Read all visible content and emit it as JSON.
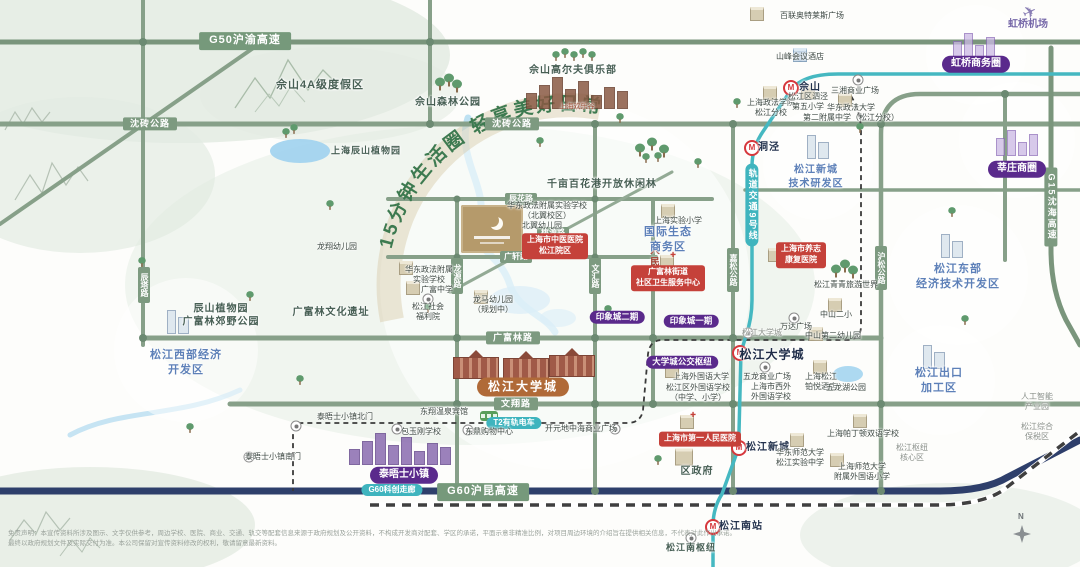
{
  "slogan": "15分钟生活圈 轻享美好日常",
  "disclaimer": {
    "line1": "免责声明：本宣传资料所涉及图示、文字仅供参考，周边学校、医院、商业、交通、轨交等配套信息来源于政府规划及公开资料，不构成开发商对配套、学区的承诺，平面示意非精准比例，对项目周边环境的介绍旨在提供相关信息，不代表对此作出承诺。",
    "line2": "最终以政府规划文件及实际交付为准。本公司保留对宣传资料修改的权利，敬请留意最新资料。"
  },
  "compass": {
    "north_label": "N"
  },
  "project": {
    "logo_icon": "crescent-moon-logo"
  },
  "colors": {
    "road_green": "#7d9a80",
    "highway_navy": "#2e3f6b",
    "metro_teal": "#3fb4be",
    "purple_pill": "#5a2a8c",
    "red_tag": "#c5413a",
    "area_blue": "#5d80b8",
    "slogan_green": "#3d7a50",
    "orange_pill": "#b06a38"
  },
  "labels": [
    {
      "n": "road-label-g50",
      "t": "G50沪渝高速",
      "x": 245,
      "y": 41,
      "c": "pill-road big"
    },
    {
      "n": "road-label-shenzhuan-west",
      "t": "沈砖公路",
      "x": 150,
      "y": 124,
      "c": "pill-road"
    },
    {
      "n": "road-label-shenzhuan",
      "t": "沈砖公路",
      "x": 512,
      "y": 124,
      "c": "pill-road"
    },
    {
      "n": "road-label-chenhua",
      "t": "辰花路",
      "x": 521,
      "y": 199,
      "c": "pill-road sm"
    },
    {
      "n": "road-label-taoyuan",
      "t": "桃源路",
      "x": 553,
      "y": 233,
      "c": "pill-road sm"
    },
    {
      "n": "road-label-guangxuan",
      "t": "广轩路",
      "x": 516,
      "y": 257,
      "c": "pill-road sm"
    },
    {
      "n": "road-label-guangfulin",
      "t": "广富林路",
      "x": 513,
      "y": 338,
      "c": "pill-road"
    },
    {
      "n": "road-label-wenxiang",
      "t": "文翔路",
      "x": 516,
      "y": 404,
      "c": "pill-road"
    },
    {
      "n": "road-label-g60",
      "t": "G60沪昆高速",
      "x": 483,
      "y": 492,
      "c": "pill-road big"
    },
    {
      "n": "road-label-g15",
      "t": "G15沈海高速",
      "x": 1051,
      "y": 207,
      "c": "pill-road vert"
    },
    {
      "n": "road-label-chenta",
      "t": "辰塔路",
      "x": 144,
      "y": 285,
      "c": "pill-road vert sm"
    },
    {
      "n": "road-label-longyuan",
      "t": "龙源路",
      "x": 457,
      "y": 276,
      "c": "pill-road vert sm"
    },
    {
      "n": "road-label-wenhui",
      "t": "文汇路",
      "x": 595,
      "y": 276,
      "c": "pill-road vert sm"
    },
    {
      "n": "road-label-renminbei",
      "t": "人民北路",
      "x": 653,
      "y": 268,
      "c": "road-red vert"
    },
    {
      "n": "road-label-jiasong",
      "t": "嘉松公路",
      "x": 733,
      "y": 270,
      "c": "pill-road vert sm"
    },
    {
      "n": "road-label-husong",
      "t": "沪松公路",
      "x": 881,
      "y": 268,
      "c": "pill-road vert sm"
    },
    {
      "n": "label-g60-corridor",
      "t": "G60科创走廊",
      "x": 392,
      "y": 490,
      "c": "teal-tag"
    },
    {
      "n": "label-t2-tram",
      "t": "T2有轨电车",
      "x": 514,
      "y": 423,
      "c": "teal-tag"
    },
    {
      "n": "label-metro-line9",
      "t": "轨道交通9号线",
      "x": 752,
      "y": 205,
      "c": "metro-vert vert"
    },
    {
      "n": "pill-hongqiao-cbd",
      "t": "虹桥商务圈",
      "x": 976,
      "y": 64,
      "c": "pill-purple"
    },
    {
      "n": "pill-xinzhuang-cbd",
      "t": "莘庄商圈",
      "x": 1017,
      "y": 169,
      "c": "pill-purple"
    },
    {
      "n": "pill-yinxiangcheng-2",
      "t": "印象城二期",
      "x": 617,
      "y": 317,
      "c": "pill-purple sm"
    },
    {
      "n": "pill-yinxiangcheng-1",
      "t": "印象城一期",
      "x": 691,
      "y": 321,
      "c": "pill-purple sm"
    },
    {
      "n": "pill-bus-hub",
      "t": "大学城公交枢纽",
      "x": 682,
      "y": 362,
      "c": "pill-purple sm"
    },
    {
      "n": "pill-thames-town",
      "t": "泰晤士小镇",
      "x": 404,
      "y": 475,
      "c": "pill-purple"
    },
    {
      "n": "pill-univ-town",
      "t": "松江大学城",
      "x": 523,
      "y": 387,
      "c": "pill-orange"
    },
    {
      "n": "area-songjiang-newcity-rd",
      "t": "松江新城\n技术研发区",
      "x": 816,
      "y": 177,
      "c": "area-blue s10"
    },
    {
      "n": "area-eco-business",
      "t": "国际生态\n商务区",
      "x": 668,
      "y": 240,
      "c": "area-blue"
    },
    {
      "n": "area-east-dev",
      "t": "松江东部\n经济技术开发区",
      "x": 958,
      "y": 277,
      "c": "area-blue"
    },
    {
      "n": "area-export-zone",
      "t": "松江出口\n加工区",
      "x": 939,
      "y": 381,
      "c": "area-blue"
    },
    {
      "n": "area-west-dev",
      "t": "松江西部经济\n开发区",
      "x": 186,
      "y": 363,
      "c": "area-blue"
    },
    {
      "n": "label-sheshan-resort",
      "t": "佘山4A级度假区",
      "x": 320,
      "y": 86,
      "c": "area-dark"
    },
    {
      "n": "label-sheshan-forest-park",
      "t": "佘山森林公园",
      "x": 448,
      "y": 103,
      "c": "area-dark s10"
    },
    {
      "n": "label-sheshan-golf",
      "t": "佘山高尔夫俱乐部",
      "x": 573,
      "y": 71,
      "c": "area-dark s10"
    },
    {
      "n": "label-happy-valley",
      "t": "上海欢乐谷",
      "x": 577,
      "y": 108,
      "c": "brown",
      "fs": 7
    },
    {
      "n": "label-chenshan-garden",
      "t": "上海辰山植物园",
      "x": 366,
      "y": 151,
      "c": "area-dark s9"
    },
    {
      "n": "label-flower-park",
      "t": "千亩百花港开放休闲林",
      "x": 602,
      "y": 185,
      "c": "area-dark s10"
    },
    {
      "n": "label-country-park",
      "t": "辰山植物园\n广富林郊野公园",
      "x": 221,
      "y": 316,
      "c": "area-dark s10"
    },
    {
      "n": "label-guangfulin-relic",
      "t": "广富林文化遗址",
      "x": 331,
      "y": 313,
      "c": "area-dark s10"
    },
    {
      "n": "label-qingqing-world",
      "t": "松江青青旅游世界",
      "x": 846,
      "y": 285,
      "c": ""
    },
    {
      "n": "label-district-gov",
      "t": "区政府",
      "x": 697,
      "y": 472,
      "c": "area-dark s10"
    },
    {
      "n": "label-songjiang-south-hub",
      "t": "松江南枢纽",
      "x": 691,
      "y": 548,
      "c": "area-dark s9"
    },
    {
      "n": "label-hongqiao-airport",
      "t": "虹桥机场",
      "x": 1028,
      "y": 25,
      "c": "area-purple"
    },
    {
      "n": "station-sheshan",
      "t": "佘山",
      "x": 810,
      "y": 88,
      "c": "station"
    },
    {
      "n": "station-dongjing",
      "t": "洞泾",
      "x": 769,
      "y": 148,
      "c": "station"
    },
    {
      "n": "station-sj-univ-town",
      "t": "松江大学城",
      "x": 772,
      "y": 355,
      "c": "station big"
    },
    {
      "n": "station-sj-newcity",
      "t": "松江新城",
      "x": 768,
      "y": 448,
      "c": "station"
    },
    {
      "n": "station-sj-south",
      "t": "松江南站",
      "x": 741,
      "y": 527,
      "c": "station"
    },
    {
      "n": "tag-tcm-hospital",
      "t": "上海市中医医院\n松江院区",
      "x": 555,
      "y": 246,
      "c": "red-tag"
    },
    {
      "n": "tag-yangzhi-hospital",
      "t": "上海市养志\n康复医院",
      "x": 801,
      "y": 255,
      "c": "red-tag"
    },
    {
      "n": "tag-gfl-health-center",
      "t": "广富林街道\n社区卫生服务中心",
      "x": 668,
      "y": 278,
      "c": "red-tag"
    },
    {
      "n": "tag-first-peoples-hospital",
      "t": "上海市第一人民医院",
      "x": 700,
      "y": 439,
      "c": "red-tag"
    },
    {
      "n": "poi-bailian-outlets",
      "t": "百联奥特莱斯广场",
      "x": 812,
      "y": 16,
      "c": ""
    },
    {
      "n": "poi-shanfeng-hotel",
      "t": "山峰会议酒店",
      "x": 800,
      "y": 57,
      "c": ""
    },
    {
      "n": "poi-sanxiang-plaza",
      "t": "三湘商业广场",
      "x": 855,
      "y": 91,
      "c": ""
    },
    {
      "n": "poi-shupl-branch",
      "t": "上海政法学院\n松江分校",
      "x": 771,
      "y": 108,
      "c": ""
    },
    {
      "n": "poi-sijing-5th-primary",
      "t": "松江区泗泾\n第五小学",
      "x": 808,
      "y": 102,
      "c": ""
    },
    {
      "n": "poi-ecupl-2nd-middle",
      "t": "华东政法大学\n第二附属中学（松江分校）",
      "x": 851,
      "y": 113,
      "c": ""
    },
    {
      "n": "poi-longxiang-kindergarten",
      "t": "龙翔幼儿园",
      "x": 337,
      "y": 247,
      "c": ""
    },
    {
      "n": "poi-ecupl-north-campus",
      "t": "华东政法附属实验学校\n（北翼校区）",
      "x": 547,
      "y": 211,
      "c": ""
    },
    {
      "n": "poi-beiyi-kindergarten",
      "t": "北翼幼儿园",
      "x": 542,
      "y": 226,
      "c": ""
    },
    {
      "n": "poi-ecupl-exp-school",
      "t": "华东政法附属\n实验学校",
      "x": 429,
      "y": 275,
      "c": ""
    },
    {
      "n": "poi-guangfu-middle",
      "t": "广富中学",
      "x": 437,
      "y": 290,
      "c": ""
    },
    {
      "n": "poi-welfare-house",
      "t": "松江社会\n福利院",
      "x": 428,
      "y": 312,
      "c": ""
    },
    {
      "n": "poi-longma-kindergarten",
      "t": "龙马幼儿园\n（规划中）",
      "x": 493,
      "y": 305,
      "c": ""
    },
    {
      "n": "poi-shiyan-primary",
      "t": "上海实验小学",
      "x": 678,
      "y": 221,
      "c": ""
    },
    {
      "n": "poi-zhongshan-2nd-primary",
      "t": "中山二小",
      "x": 836,
      "y": 315,
      "c": ""
    },
    {
      "n": "poi-zhongshan-2nd-kg",
      "t": "中山第二幼儿园",
      "x": 833,
      "y": 336,
      "c": ""
    },
    {
      "n": "poi-wanda-plaza",
      "t": "万达广场",
      "x": 796,
      "y": 327,
      "c": ""
    },
    {
      "n": "poi-tram-stop-univ-town",
      "t": "松江大学城",
      "x": 762,
      "y": 333,
      "c": "gray"
    },
    {
      "n": "poi-wulong-plaza",
      "t": "五龙商业广场",
      "x": 767,
      "y": 377,
      "c": ""
    },
    {
      "n": "poi-sisu",
      "t": "上海外国语大学",
      "x": 701,
      "y": 377,
      "c": ""
    },
    {
      "n": "poi-sj-foreign-school",
      "t": "松江区外国语学校\n（中学、小学）",
      "x": 698,
      "y": 393,
      "c": ""
    },
    {
      "n": "poi-xiwai-school",
      "t": "上海市西外\n外国语学校",
      "x": 771,
      "y": 392,
      "c": ""
    },
    {
      "n": "poi-boyue-hotel",
      "t": "上海松江\n铂悦酒店",
      "x": 821,
      "y": 382,
      "c": ""
    },
    {
      "n": "poi-wulong-lake-park",
      "t": "五龙湖公园",
      "x": 846,
      "y": 388,
      "c": ""
    },
    {
      "n": "poi-thames-north-gate",
      "t": "泰晤士小镇北门",
      "x": 345,
      "y": 417,
      "c": ""
    },
    {
      "n": "poi-thames-south-gate",
      "t": "泰晤士小镇南门",
      "x": 273,
      "y": 457,
      "c": ""
    },
    {
      "n": "poi-dongxiang-spa-hotel",
      "t": "东翔温泉宾馆",
      "x": 444,
      "y": 412,
      "c": ""
    },
    {
      "n": "poi-baoyugang-school",
      "t": "包玉刚学校",
      "x": 421,
      "y": 432,
      "c": ""
    },
    {
      "n": "poi-dongding-mall",
      "t": "东鼎购物中心",
      "x": 489,
      "y": 432,
      "c": ""
    },
    {
      "n": "poi-kaiyuan-mall",
      "t": "开元地中海商业广场",
      "x": 581,
      "y": 429,
      "c": ""
    },
    {
      "n": "poi-ecnu-sj-middle",
      "t": "华东师范大学\n松江实验中学",
      "x": 800,
      "y": 458,
      "c": ""
    },
    {
      "n": "poi-paddington-school",
      "t": "上海帕丁顿双语学校",
      "x": 863,
      "y": 434,
      "c": ""
    },
    {
      "n": "poi-shnu-foreign-primary",
      "t": "上海师范大学\n附属外国语小学",
      "x": 862,
      "y": 472,
      "c": ""
    },
    {
      "n": "poi-ai-industry-park",
      "t": "人工智能\n产业园",
      "x": 1037,
      "y": 402,
      "c": "gray"
    },
    {
      "n": "poi-bonded-zone",
      "t": "松江综合\n保税区",
      "x": 1037,
      "y": 432,
      "c": "gray"
    },
    {
      "n": "poi-hub-core-area",
      "t": "松江枢纽\n核心区",
      "x": 912,
      "y": 453,
      "c": "gray"
    }
  ],
  "icons": [
    {
      "n": "metro-station-icon-sheshan",
      "t": "metro",
      "x": 791,
      "y": 88
    },
    {
      "n": "metro-station-icon-dongjing",
      "t": "metro",
      "x": 752,
      "y": 148
    },
    {
      "n": "metro-station-icon-univ-town",
      "t": "metro",
      "x": 740,
      "y": 353
    },
    {
      "n": "metro-station-icon-newcity",
      "t": "metro",
      "x": 739,
      "y": 448
    },
    {
      "n": "metro-station-icon-south",
      "t": "metro",
      "x": 713,
      "y": 527
    },
    {
      "n": "tram-stop-icon-sanxiang",
      "t": "stop",
      "x": 858,
      "y": 80
    },
    {
      "n": "tram-stop-icon-wanda",
      "t": "stop",
      "x": 794,
      "y": 318
    },
    {
      "n": "tram-stop-icon-univ-town",
      "t": "stop",
      "x": 748,
      "y": 333
    },
    {
      "n": "tram-stop-icon-wulong",
      "t": "stop",
      "x": 765,
      "y": 367
    },
    {
      "n": "tram-stop-icon-thames-north",
      "t": "stop",
      "x": 296,
      "y": 426
    },
    {
      "n": "tram-stop-icon-thames-south",
      "t": "stop",
      "x": 249,
      "y": 457
    },
    {
      "n": "tram-stop-icon-baoyugang",
      "t": "stop",
      "x": 397,
      "y": 429
    },
    {
      "n": "tram-stop-icon-dongding",
      "t": "stop",
      "x": 468,
      "y": 430
    },
    {
      "n": "tram-stop-icon-kaiyuan",
      "t": "stop",
      "x": 615,
      "y": 429
    },
    {
      "n": "tram-stop-icon-south-hub",
      "t": "stop",
      "x": 691,
      "y": 538
    },
    {
      "n": "welfare-house-icon",
      "t": "stop",
      "x": 428,
      "y": 299
    },
    {
      "n": "outlets-building-icon",
      "t": "cube",
      "x": 757,
      "y": 14
    },
    {
      "n": "hotel-building-icon-shanfeng",
      "t": "cubeblue",
      "x": 800,
      "y": 55
    },
    {
      "n": "school-building-icon-shupl",
      "t": "cube",
      "x": 770,
      "y": 93
    },
    {
      "n": "school-building-icon-sijing5",
      "t": "cube",
      "x": 808,
      "y": 92
    },
    {
      "n": "school-building-icon-ecupl2",
      "t": "cube",
      "x": 845,
      "y": 100
    },
    {
      "n": "school-building-icon-shiyan",
      "t": "cube",
      "x": 668,
      "y": 211
    },
    {
      "n": "school-building-icon-zhongshan2",
      "t": "cube",
      "x": 835,
      "y": 305
    },
    {
      "n": "school-building-icon-zhongshan-kg",
      "t": "cube",
      "x": 816,
      "y": 334
    },
    {
      "n": "school-building-icon-sisu",
      "t": "cube",
      "x": 672,
      "y": 371
    },
    {
      "n": "school-building-icon-paddington",
      "t": "cube",
      "x": 860,
      "y": 421
    },
    {
      "n": "school-building-icon-shnu",
      "t": "cube",
      "x": 837,
      "y": 460
    },
    {
      "n": "school-building-icon-ecnu",
      "t": "cube",
      "x": 797,
      "y": 440
    },
    {
      "n": "school-building-icon-longma",
      "t": "cube",
      "x": 481,
      "y": 297
    },
    {
      "n": "school-building-icon-ecupl-exp",
      "t": "cube",
      "x": 406,
      "y": 268
    },
    {
      "n": "school-building-icon-guangfu",
      "t": "cube",
      "x": 413,
      "y": 288
    },
    {
      "n": "hotel-building-icon-boyue",
      "t": "cube",
      "x": 820,
      "y": 367
    },
    {
      "n": "hospital-building-icon-yangzhi",
      "t": "hospital",
      "x": 775,
      "y": 255
    },
    {
      "n": "hospital-building-icon-gfl",
      "t": "hospital",
      "x": 667,
      "y": 262
    },
    {
      "n": "hospital-building-icon-first",
      "t": "hospital",
      "x": 687,
      "y": 422
    },
    {
      "n": "government-building-icon",
      "t": "gov",
      "x": 684,
      "y": 457
    },
    {
      "n": "towers-icon-west-dev",
      "t": "towers",
      "x": 178,
      "y": 322
    },
    {
      "n": "towers-icon-east-dev",
      "t": "towers",
      "x": 952,
      "y": 246
    },
    {
      "n": "towers-icon-newcity-rd",
      "t": "towers",
      "x": 818,
      "y": 147
    },
    {
      "n": "towers-icon-export-zone",
      "t": "towers",
      "x": 934,
      "y": 357
    },
    {
      "n": "purple-city-icon-xinzhuang",
      "t": "city",
      "x": 1017,
      "y": 143
    },
    {
      "n": "purple-city-icon-hongqiao",
      "t": "city",
      "x": 974,
      "y": 46
    },
    {
      "n": "thames-skyline-icon",
      "t": "thames",
      "x": 400,
      "y": 449
    },
    {
      "n": "happy-valley-skyline-icon",
      "t": "thamesbrown",
      "x": 577,
      "y": 93
    },
    {
      "n": "university-building-icon-1",
      "t": "uni",
      "x": 476,
      "y": 368
    },
    {
      "n": "university-building-icon-2",
      "t": "uni",
      "x": 526,
      "y": 369
    },
    {
      "n": "university-building-icon-3",
      "t": "uni",
      "x": 572,
      "y": 366
    },
    {
      "n": "airplane-icon",
      "t": "plane",
      "x": 1030,
      "y": 13
    },
    {
      "n": "tram-vehicle-icon",
      "t": "tram",
      "x": 489,
      "y": 416
    },
    {
      "n": "compass-icon",
      "t": "compass",
      "x": 1022,
      "y": 532
    },
    {
      "n": "project-logo-block",
      "t": "project",
      "x": 492,
      "y": 229
    }
  ],
  "trees": [
    [
      440,
      84,
      1
    ],
    [
      449,
      80,
      1
    ],
    [
      457,
      86,
      1
    ],
    [
      556,
      56,
      0
    ],
    [
      565,
      53,
      0
    ],
    [
      574,
      56,
      0
    ],
    [
      583,
      53,
      0
    ],
    [
      592,
      56,
      0
    ],
    [
      640,
      150,
      1
    ],
    [
      652,
      144,
      1
    ],
    [
      664,
      151,
      1
    ],
    [
      646,
      158,
      0
    ],
    [
      658,
      157,
      0
    ],
    [
      836,
      271,
      1
    ],
    [
      845,
      266,
      1
    ],
    [
      853,
      272,
      1
    ],
    [
      286,
      133,
      0
    ],
    [
      294,
      129,
      0
    ],
    [
      142,
      262,
      0
    ],
    [
      250,
      296,
      0
    ],
    [
      330,
      205,
      0
    ],
    [
      620,
      118,
      0
    ],
    [
      698,
      163,
      0
    ],
    [
      860,
      128,
      0
    ],
    [
      952,
      212,
      0
    ],
    [
      428,
      308,
      0
    ],
    [
      608,
      310,
      0
    ],
    [
      300,
      380,
      0
    ],
    [
      658,
      460,
      0
    ],
    [
      737,
      103,
      0
    ],
    [
      540,
      142,
      0
    ],
    [
      965,
      320,
      0
    ],
    [
      190,
      428,
      0
    ]
  ]
}
